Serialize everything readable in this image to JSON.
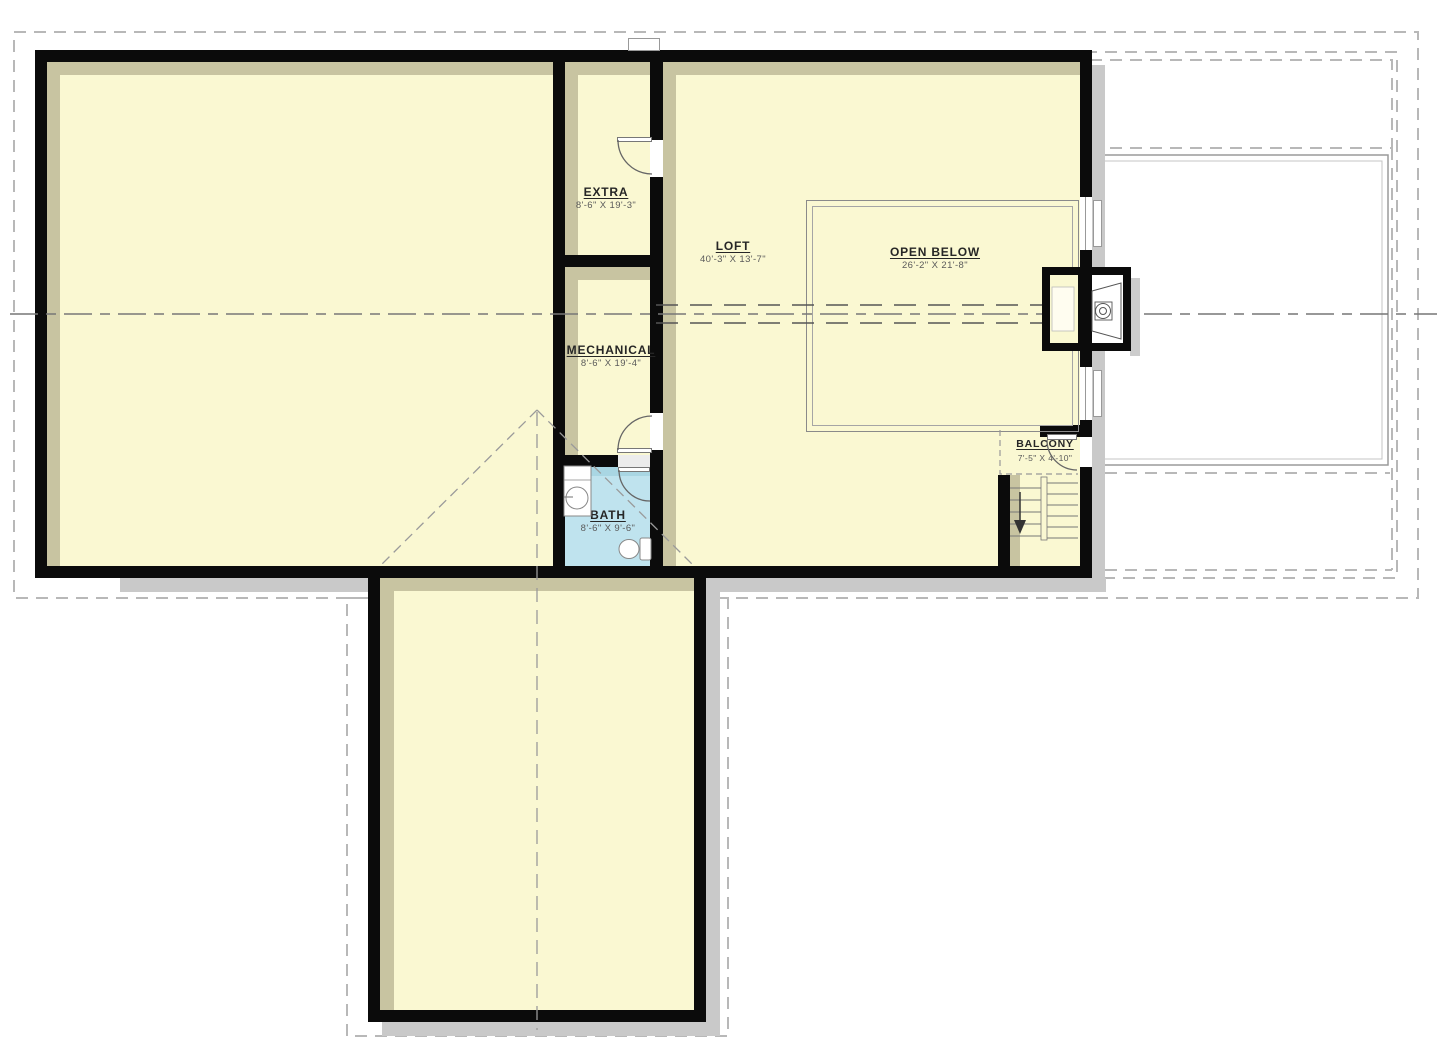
{
  "plan_title": "Loft Level Floor Plan",
  "rooms": [
    {
      "name": "EXTRA",
      "dims": "8'-6\" X 19'-3\""
    },
    {
      "name": "LOFT",
      "dims": "40'-3\" X 13'-7\""
    },
    {
      "name": "OPEN BELOW",
      "dims": "26'-2\" X 21'-8\""
    },
    {
      "name": "MECHANICAL",
      "dims": "8'-6\" X 19'-4\""
    },
    {
      "name": "BATH",
      "dims": "8'-6\" X 9'-6\""
    },
    {
      "name": "BALCONY",
      "dims": "7'-5\" X 4'-10\""
    }
  ],
  "stairs": {
    "direction": "down"
  },
  "colors": {
    "floor": "#FAF8D2",
    "bath_floor": "#BFE3EE",
    "wall": "#0B0B0B",
    "inner_shadow": "#C8C4A1",
    "outer_shadow": "#C9C9C9",
    "roof_dashed": "#B8B8B8",
    "centerline": "#777777",
    "label_text": "#262626",
    "dim_text": "#5A5A5A"
  }
}
